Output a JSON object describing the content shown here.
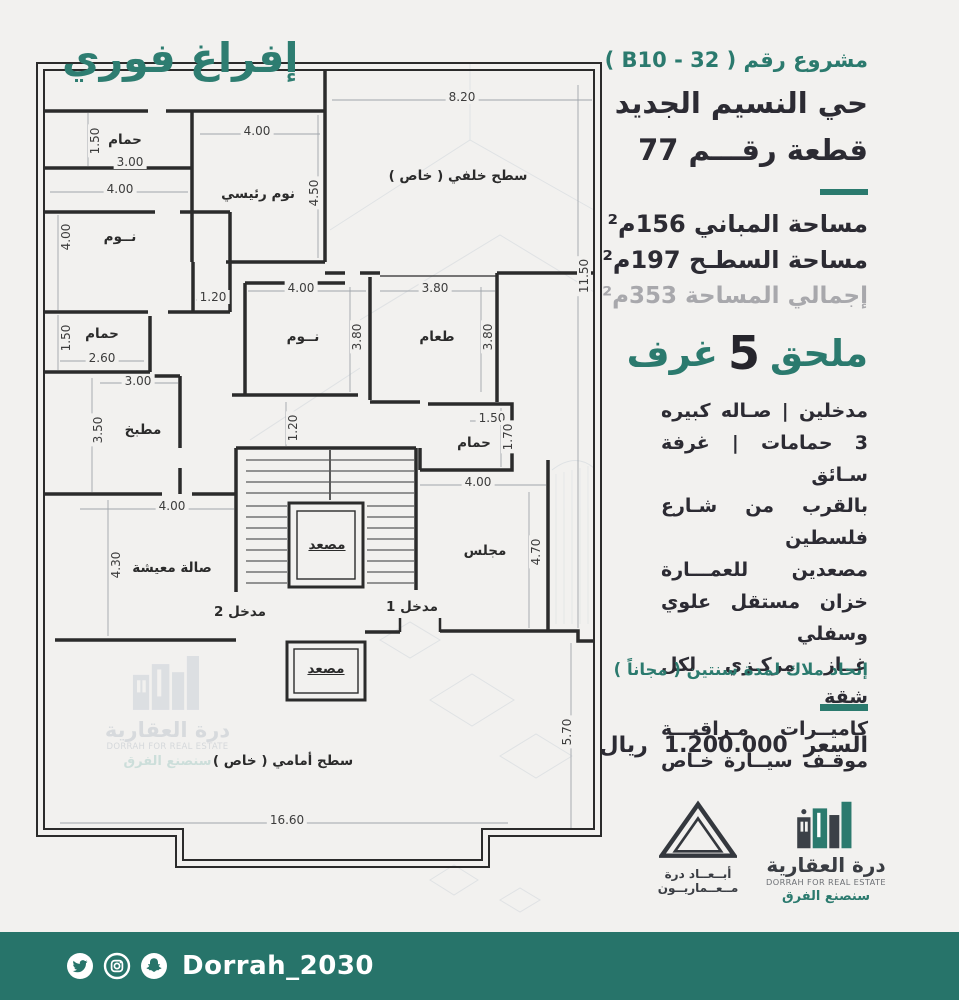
{
  "title": "إفراغ فوري",
  "panel": {
    "project_label": "مشروع رقم ( B10 - 32 )",
    "district": "حي النسيم الجديد",
    "plot": "قطعة رقـــم 77",
    "building_area": "مساحة المباني 156م²",
    "roof_area": "مساحة السطـح 197م²",
    "total_area": "إجمالي المساحة 353م²",
    "annex_word1": "ملحق",
    "annex_number": "5",
    "annex_word2": "غرف",
    "features": [
      "مدخلين | صـاله كبيره",
      "3 حمامات | غرفة سـائق",
      "بالقرب من شـارع فلسطين",
      "مصعدين للعمـــارة",
      "خزان مستقل علوي وسفلي",
      "غــاز مركـزي لكل شقة",
      "كاميــرات مـراقبـــة",
      "موقـف سيــارة خـاص"
    ],
    "union_note": "إتحاد ملاك لمدة سنتين ( مجاناً )",
    "price_label": "السعر",
    "price_value": "1.200.000",
    "price_currency": "ريال"
  },
  "plan": {
    "elevator_label": "مصعد",
    "rooms": [
      {
        "t": "حمام",
        "x": 125,
        "y": 140
      },
      {
        "t": "نوم رئيسي",
        "x": 258,
        "y": 194
      },
      {
        "t": "سطح خلفي ( خاص )",
        "x": 458,
        "y": 176
      },
      {
        "t": "نــوم",
        "x": 120,
        "y": 237
      },
      {
        "t": "حمام",
        "x": 102,
        "y": 334
      },
      {
        "t": "مطبخ",
        "x": 143,
        "y": 430
      },
      {
        "t": "نــوم",
        "x": 303,
        "y": 337
      },
      {
        "t": "طعام",
        "x": 437,
        "y": 337
      },
      {
        "t": "حمام",
        "x": 474,
        "y": 443
      },
      {
        "t": "صالة معيشة",
        "x": 172,
        "y": 568
      },
      {
        "t": "مجلس",
        "x": 485,
        "y": 551
      },
      {
        "t": "مصعد",
        "x": 327,
        "y": 545,
        "u": true
      },
      {
        "t": "مصعد",
        "x": 326,
        "y": 669,
        "u": true
      },
      {
        "t": "سطح أمامي ( خاص )",
        "x": 283,
        "y": 761
      },
      {
        "t": "مدخل 1",
        "x": 412,
        "y": 607
      },
      {
        "t": "مدخل 2",
        "x": 240,
        "y": 612
      }
    ],
    "dims_h": [
      {
        "t": "8.20",
        "x": 462,
        "y": 97
      },
      {
        "t": "4.00",
        "x": 257,
        "y": 131
      },
      {
        "t": "3.00",
        "x": 130,
        "y": 162
      },
      {
        "t": "4.00",
        "x": 120,
        "y": 189
      },
      {
        "t": "1.20",
        "x": 213,
        "y": 297
      },
      {
        "t": "4.00",
        "x": 301,
        "y": 288
      },
      {
        "t": "3.80",
        "x": 435,
        "y": 288
      },
      {
        "t": "2.60",
        "x": 102,
        "y": 358
      },
      {
        "t": "3.00",
        "x": 138,
        "y": 381
      },
      {
        "t": "1.50",
        "x": 492,
        "y": 418
      },
      {
        "t": "4.00",
        "x": 478,
        "y": 482
      },
      {
        "t": "4.00",
        "x": 172,
        "y": 506
      },
      {
        "t": "16.60",
        "x": 287,
        "y": 820
      }
    ],
    "dims_v": [
      {
        "t": "1.50",
        "x": 95,
        "y": 141
      },
      {
        "t": "4.50",
        "x": 314,
        "y": 193
      },
      {
        "t": "11.50",
        "x": 584,
        "y": 276
      },
      {
        "t": "4.00",
        "x": 66,
        "y": 237
      },
      {
        "t": "1.50",
        "x": 66,
        "y": 338
      },
      {
        "t": "3.80",
        "x": 357,
        "y": 337
      },
      {
        "t": "3.80",
        "x": 488,
        "y": 337
      },
      {
        "t": "3.50",
        "x": 98,
        "y": 430
      },
      {
        "t": "1.70",
        "x": 508,
        "y": 437
      },
      {
        "t": "1.20",
        "x": 293,
        "y": 428
      },
      {
        "t": "4.30",
        "x": 116,
        "y": 565
      },
      {
        "t": "4.70",
        "x": 536,
        "y": 552
      },
      {
        "t": "5.70",
        "x": 567,
        "y": 732
      }
    ]
  },
  "logos": {
    "abaad": {
      "line1": "أبــعــاد درة",
      "line2": "مــعــماريــون"
    },
    "dorrah": {
      "name": "درة العقارية",
      "en": "DORRAH FOR REAL ESTATE",
      "slogan": "سنصنع الفرق"
    }
  },
  "footer": {
    "handle": "Dorrah_2030",
    "icons": [
      "twitter-icon",
      "instagram-icon",
      "snapchat-icon"
    ]
  },
  "colors": {
    "teal": "#2b7a6e",
    "footer_teal": "#27746a",
    "dark": "#2c2b33",
    "gray": "#a8a8ac",
    "wall": "#2b2b2b"
  }
}
